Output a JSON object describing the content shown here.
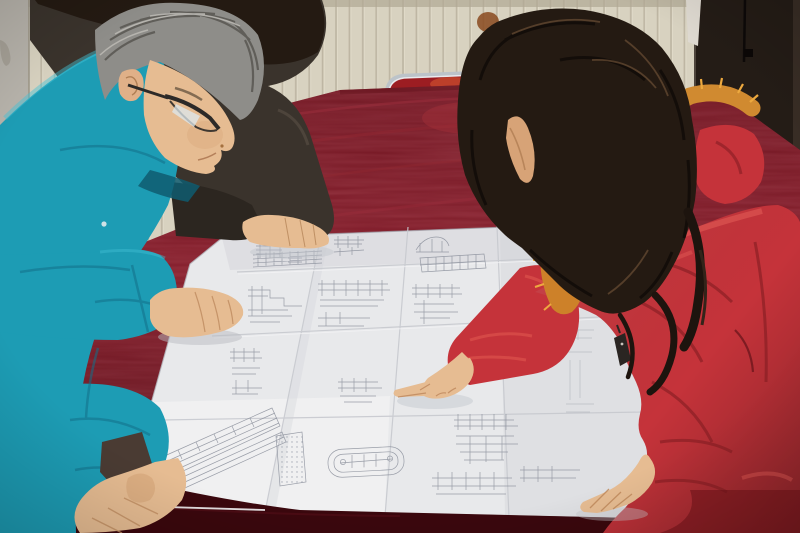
{
  "meta": {
    "type": "photograph",
    "width": 800,
    "height": 533,
    "description": "Two colleagues lean over a large folded construction blueprint spread on a red velvet covered table; a woman in a red fur-trimmed parka points at a detail while a gray-haired man in a teal work jacket studies the drawing."
  },
  "scene": {
    "setting": "Indoor room with cream vertically-grooved panel wall, a dark door on the right and a chrome-framed chair behind the table",
    "people": [
      {
        "id": "man-teal",
        "description": "Middle-aged man with gray hair and dark-rimmed glasses, wearing a teal work jacket, bent over the drawing with both hands on the table"
      },
      {
        "id": "woman-red",
        "description": "Woman with long dark wavy hair, red down parka with orange fur-trimmed hood, pointing at the blueprint with her right index finger, left hand resting on the paper"
      },
      {
        "id": "colleague-behind",
        "description": "Partially visible person in a dark jacket standing behind the man, right hand resting on the top edge of the drawing"
      }
    ],
    "objects": [
      {
        "id": "blueprint",
        "description": "Large folded white engineering drawing with many small construction details, schedules, an oval tank detail and fold creases"
      },
      {
        "id": "table",
        "description": "Large table draped in deep crimson velvet"
      },
      {
        "id": "chair",
        "description": "Chrome tube chair with red seat behind the table"
      },
      {
        "id": "wall",
        "description": "Cream paneled wall with a rust stain"
      },
      {
        "id": "door",
        "description": "Very dark brown door filling the right edge"
      }
    ]
  },
  "colors": {
    "wall": "#d8d2c0",
    "wall-left": "#b7b3ab",
    "door": "#241c16",
    "velvet": "#7d1724",
    "velvet-dark": "#3a070d",
    "paper": "#e8e9eb",
    "teal": "#1d9cb4",
    "teal-dark": "#13768e",
    "coat-red": "#c5333a",
    "coat-shadow": "#8e2026",
    "fur": "#cd8129",
    "hair-dark": "#241a12",
    "hair-gray": "#8e8d89",
    "skin": "#e6bc92",
    "chair-red": "#9c1d22",
    "chrome": "#bcc3c9",
    "line-blue": "#8a8f9b",
    "dark-jacket": "#3a332c"
  }
}
